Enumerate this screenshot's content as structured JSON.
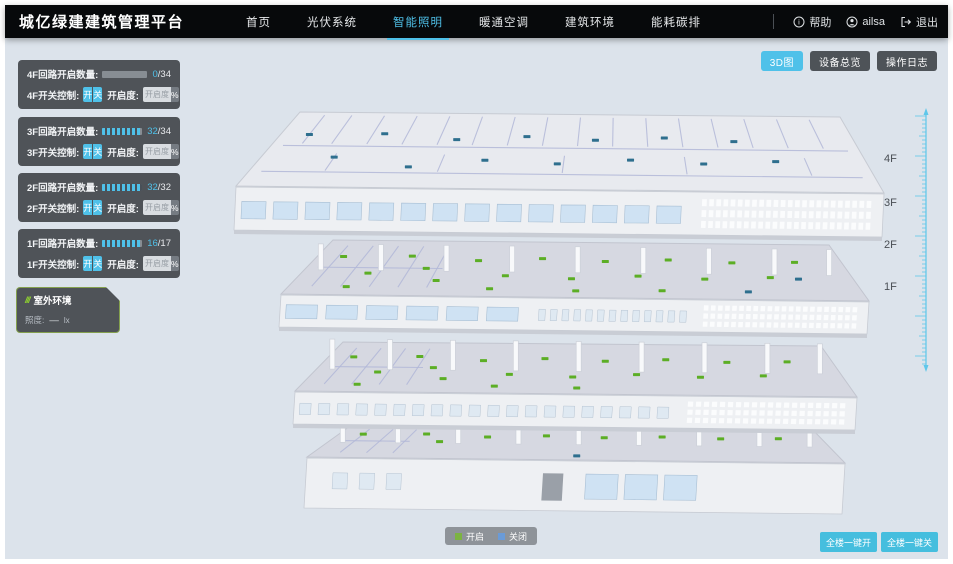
{
  "header": {
    "title": "城亿绿建建筑管理平台",
    "nav": [
      {
        "label": "首页",
        "active": false
      },
      {
        "label": "光伏系统",
        "active": false
      },
      {
        "label": "智能照明",
        "active": true
      },
      {
        "label": "暖通空调",
        "active": false
      },
      {
        "label": "建筑环境",
        "active": false
      },
      {
        "label": "能耗碳排",
        "active": false
      }
    ],
    "help": "帮助",
    "user": "ailsa",
    "logout": "退出"
  },
  "view_buttons": {
    "view3d": "3D图",
    "device": "设备总览",
    "log": "操作日志"
  },
  "floor_panels": [
    {
      "row_label": "4F回路开启数量:",
      "open": 0,
      "total": 34,
      "open_display": "0",
      "total_display": "/34",
      "switch_label": "4F开关控制:",
      "btn_on": "开",
      "btn_off": "关",
      "dim_label": "开启度:",
      "dim_placeholder": "开启度",
      "percent": "%"
    },
    {
      "row_label": "3F回路开启数量:",
      "open": 32,
      "total": 34,
      "open_display": "32",
      "total_display": "/34",
      "switch_label": "3F开关控制:",
      "btn_on": "开",
      "btn_off": "关",
      "dim_label": "开启度:",
      "dim_placeholder": "开启度",
      "percent": "%"
    },
    {
      "row_label": "2F回路开启数量:",
      "open": 32,
      "total": 32,
      "open_display": "32",
      "total_display": "/32",
      "switch_label": "2F开关控制:",
      "btn_on": "开",
      "btn_off": "关",
      "dim_label": "开启度:",
      "dim_placeholder": "开启度",
      "percent": "%"
    },
    {
      "row_label": "1F回路开启数量:",
      "open": 16,
      "total": 17,
      "open_display": "16",
      "total_display": "/17",
      "switch_label": "1F开关控制:",
      "btn_on": "开",
      "btn_off": "关",
      "dim_label": "开启度:",
      "dim_placeholder": "开启度",
      "percent": "%"
    }
  ],
  "outdoor": {
    "title": "室外环境",
    "icon": "leaf-slashes-icon",
    "row_label": "照度:",
    "row_value": "—",
    "row_unit": "lx"
  },
  "floor_labels": [
    "4F",
    "3F",
    "2F",
    "1F"
  ],
  "legend": {
    "on_label": "开启",
    "on_color": "#7cb342",
    "off_label": "关闭",
    "off_color": "#6a9bd8"
  },
  "bulk": {
    "all_on": "全楼一键开",
    "all_off": "全楼一键关"
  },
  "building": {
    "open_color": "#5cae25",
    "closed_color": "#2e6f8e",
    "floors": [
      {
        "label": "4F",
        "open_count": 0,
        "closed_count": 14
      },
      {
        "label": "3F",
        "open_count": 20,
        "closed_count": 2
      },
      {
        "label": "2F",
        "open_count": 19,
        "closed_count": 0
      },
      {
        "label": "1F",
        "open_count": 9,
        "closed_count": 1
      }
    ]
  },
  "colors": {
    "accent": "#4fc1e9",
    "header_bg": "#07090b",
    "main_bg": "#dce3eb"
  }
}
